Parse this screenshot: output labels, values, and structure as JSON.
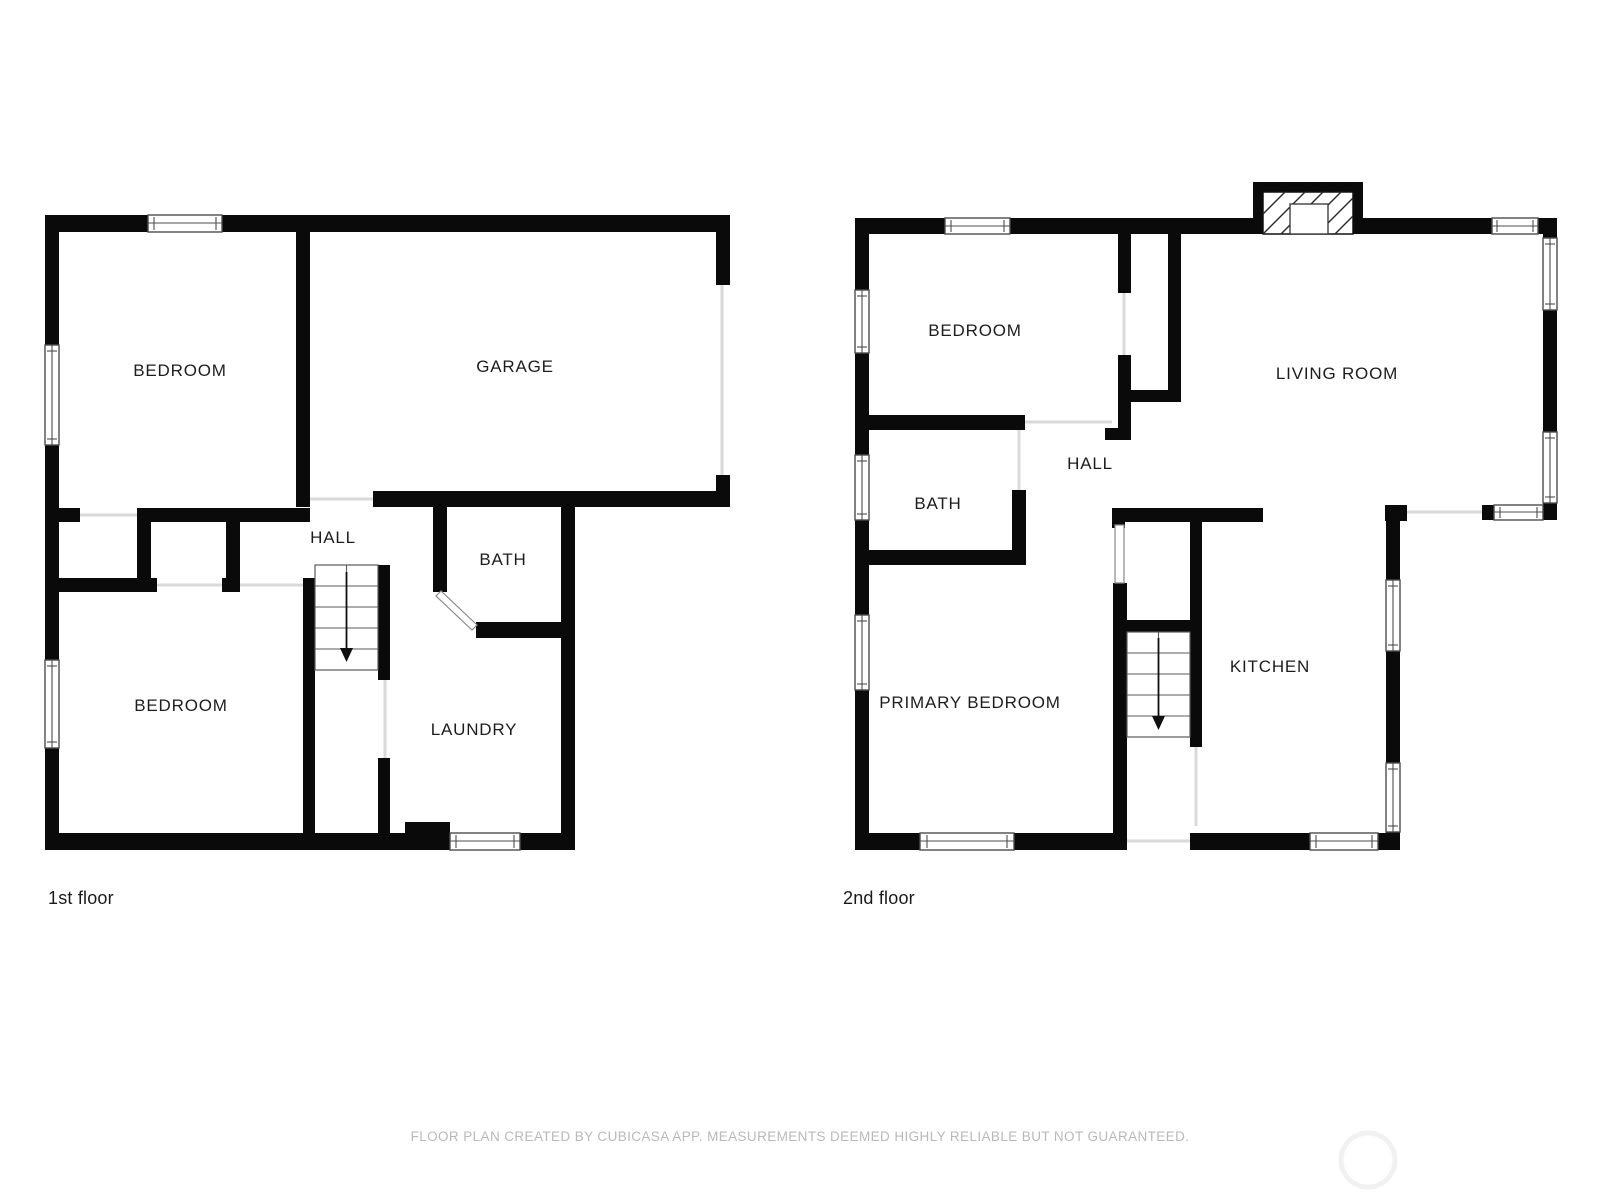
{
  "page": {
    "type": "floor-plan",
    "background": "#ffffff",
    "footer_disclaimer": "FLOOR PLAN CREATED BY CUBICASA APP. MEASUREMENTS DEEMED HIGHLY RELIABLE BUT NOT GUARANTEED."
  },
  "colors": {
    "wall": "#0a0a0a",
    "door_opening": "#d9d9d9",
    "window_outline": "#4d4d4d",
    "label_text": "#1d1d1d",
    "caption_text": "#1a1a1a",
    "footer_text": "#b9b9b9"
  },
  "floor1": {
    "caption": "1st floor",
    "labels": {
      "bedroom_top": "BEDROOM",
      "garage": "GARAGE",
      "hall": "HALL",
      "bath": "BATH",
      "bedroom_bottom": "BEDROOM",
      "laundry": "LAUNDRY"
    }
  },
  "floor2": {
    "caption": "2nd floor",
    "labels": {
      "bedroom": "BEDROOM",
      "living_room": "LIVING ROOM",
      "hall": "HALL",
      "bath": "BATH",
      "primary_bedroom": "PRIMARY BEDROOM",
      "kitchen": "KITCHEN"
    }
  }
}
